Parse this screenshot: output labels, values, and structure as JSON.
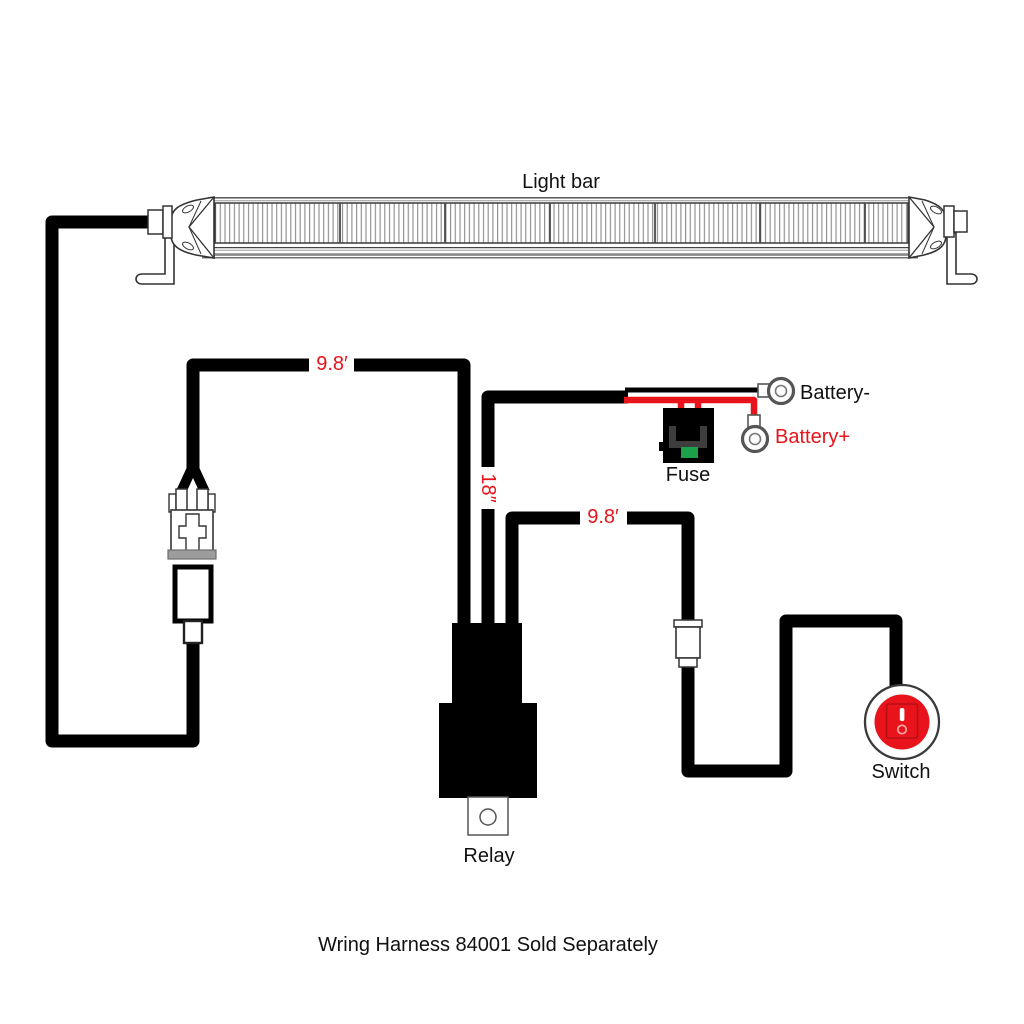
{
  "title": "Light bar",
  "footer_note": "Wring Harness 84001 Sold Separately",
  "labels": {
    "lightbar_wire_length": "9.8′",
    "fuse_wire_length": "18″",
    "switch_wire_length": "9.8′",
    "fuse": "Fuse",
    "battery_negative": "Battery-",
    "battery_positive": "Battery+",
    "relay": "Relay",
    "switch": "Switch"
  },
  "colors": {
    "wire_black": "#000000",
    "highlight_red": "#e8131b",
    "fuse_green": "#1ca04a",
    "outline_gray": "#3a3a3a"
  }
}
